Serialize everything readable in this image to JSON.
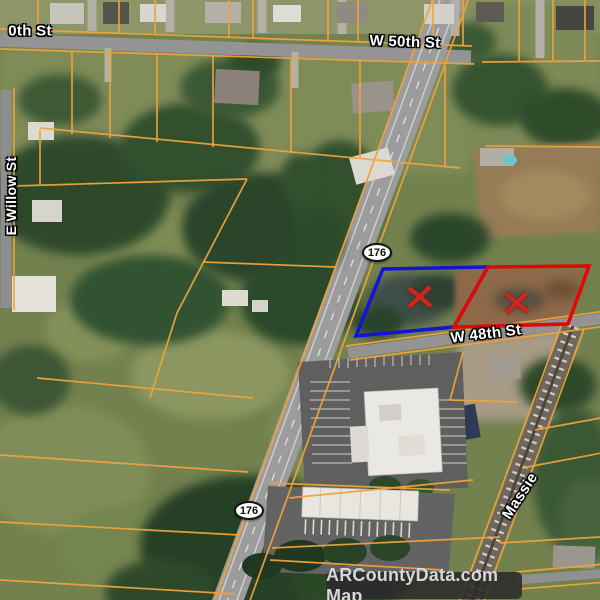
{
  "map": {
    "provider": "ARCountyData.com Map",
    "highway_shield": "176",
    "streets": {
      "w50th": "W 50th St",
      "w50th_partial": "0th St",
      "e_willow": "E Willow St",
      "w48th": "W 48th St",
      "massie": "Massie"
    },
    "colors": {
      "parcel_line": "#F0A33C",
      "highlight_blue": "#1514D2",
      "highlight_red": "#E30808",
      "marker_x": "#C9281C"
    }
  }
}
